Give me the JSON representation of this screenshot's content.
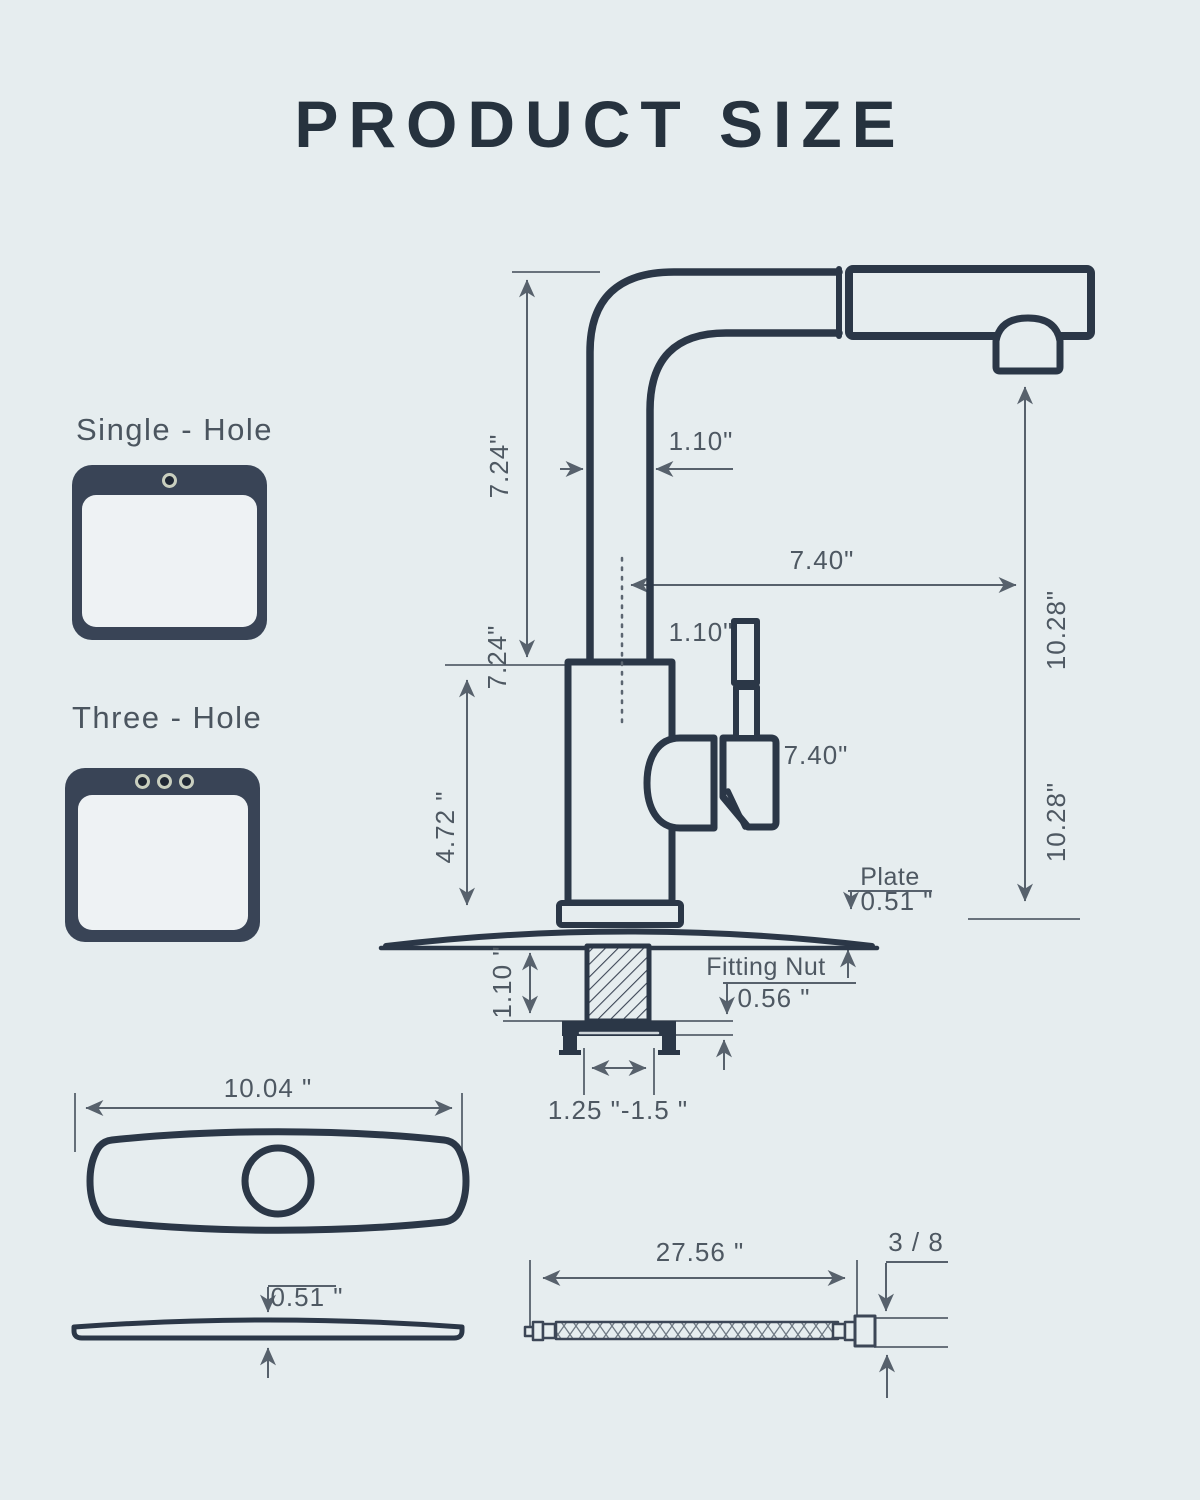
{
  "title": "PRODUCT SIZE",
  "hole_options": [
    {
      "label": "Single - Hole"
    },
    {
      "label": "Three - Hole"
    }
  ],
  "dims": {
    "spout_height": "7.24\"",
    "spout_pipe_width": "1.10\"",
    "spout_reach": "7.40\"",
    "body_height": "7.24\"",
    "handle_width": "1.10\"",
    "handle_height": "7.40\"",
    "base_height": "4.72 \"",
    "spout_to_deck": "10.28\"",
    "spout_to_deck_2": "10.28\"",
    "plate_label": "Plate",
    "plate_thickness": "0.51 \"",
    "shank_length": "1.10 \"",
    "fitting_nut_label": "Fitting Nut",
    "fitting_nut_thickness": "0.56 \"",
    "hole_size_range": "1.25 \"-1.5 \"",
    "plate_width": "10.04 \"",
    "plate_side_thickness": "0.51 \"",
    "hose_length": "27.56 \"",
    "hose_connector_size": "3 / 8"
  },
  "colors": {
    "background": "#e6edef",
    "ink": "#2b3747",
    "dimension": "#57616c",
    "icon_fill": "#394456",
    "hole_ring": "#c9cfbf"
  }
}
